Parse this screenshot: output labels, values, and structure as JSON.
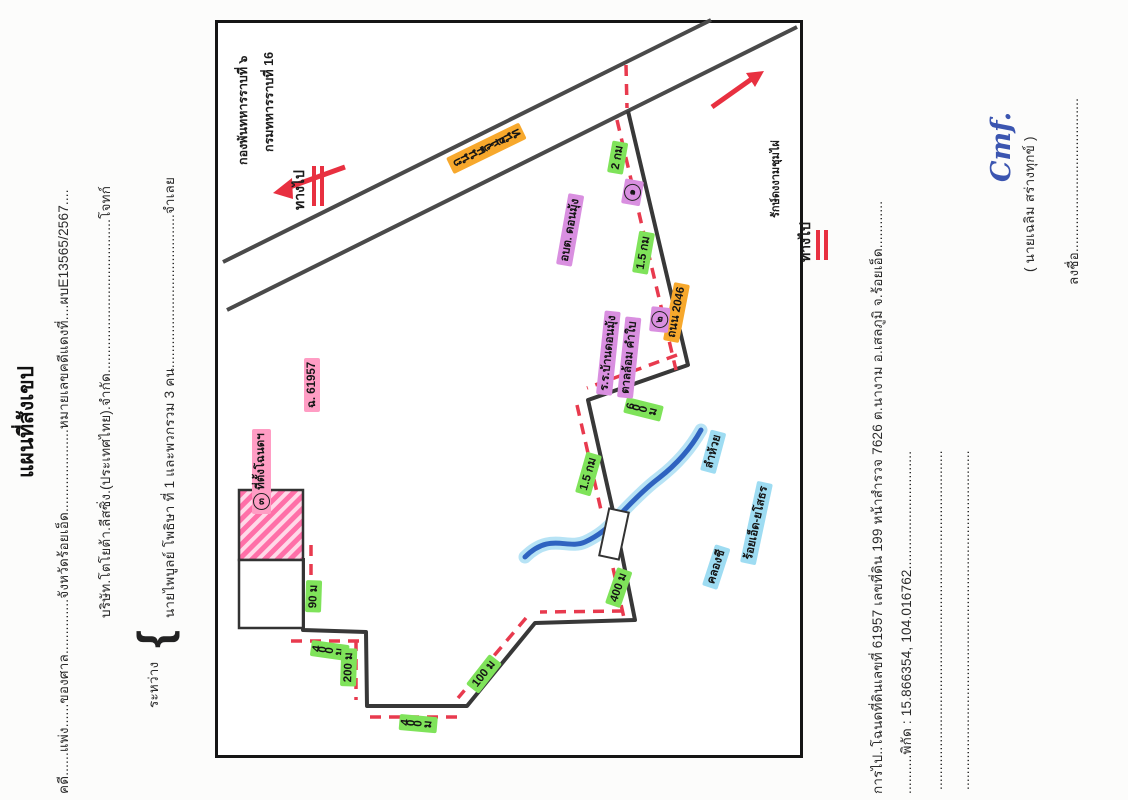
{
  "header": {
    "title": "แผนที่สังเขป",
    "case_line": "คดี......แพ่ง......ของศาล..............จังหวัดร้อยเอ็ด.....................หมายเลขคดีแดงที่....ผบE13565/2567....",
    "plaintiff_line": "บริษัท.โตโยต้า.ลีสซิ่ง.(ประเทศไทย).จำกัด.......................................โจทก์",
    "between_label": "ระหว่าง",
    "brace": "{",
    "defendant_line": "นายไพบูลย์ โพธิษา ที่ 1 และพวกรวม 3 คน.......................................จำเลย"
  },
  "footer": {
    "destination_line": "การไป..โฉนดที่ดินเลขที่ 61957 เลขที่ดิน 199 หน้าสำรวจ 7626 ต.นางาม อ.เสลภูมิ จ.ร้อยเอ็ด............",
    "coords_line": "..........พิกัด : 15.866354, 104.016762..............................",
    "dotted_line_1": "......................................................................................",
    "dotted_line_2": "......................................................................................",
    "sign_line": "ลงชื่อ.......................................",
    "signature": "Cmf.",
    "signer_name": "(        นายเฉลิม  สร่างทุกข์        )"
  },
  "map": {
    "go_to_1": "ทางไป",
    "go_to_1_dest_line1": "กองพันทหารราบที่ ๖",
    "go_to_1_dest_line2": "กรมทหารราบที่ 16",
    "main_road": "ถนนแจ้งสนิท",
    "branch_road": "ถนน 2046",
    "marker_1": "๑",
    "marker_2": "๒",
    "marker_3": "๓",
    "place_subdistrict": "อบต. ดอนมุ้ง",
    "school_line1": "ร.ร.บ้านดอนมุ้ง",
    "school_line2": "ตาลล้อม คำใบ",
    "stream": "ลำห้วย",
    "canal": "คลองชี",
    "canal_route": "ร้อยเอ็ด-ยโสธร",
    "go_to_2": "ทางไป",
    "go_to_2_dest": "รักษ์ดงงามชุมไผ่",
    "plot_label_line1": "ที่ตั้งโฉนดฯ",
    "plot_label_line2": "ฉ. 61957",
    "distances": {
      "seg1": "2 กม",
      "seg2": "1.5 กม",
      "seg3": "600 ม",
      "seg4": "1.5 กม",
      "seg5": "400 ม",
      "seg6": "400 ม",
      "seg7": "200 ม",
      "seg8": "400 ม",
      "seg9": "100 ม",
      "seg10": "90 ม"
    },
    "colors": {
      "highlight_green": "#7fe35a",
      "highlight_orange": "#f7a82c",
      "highlight_purple": "#d98fe0",
      "highlight_pink": "#ff9dc4",
      "highlight_blue": "#9edcf2",
      "route_red": "#e83a4e",
      "road_gray": "#4a4a4a",
      "stream_blue": "#2f63c0"
    }
  }
}
